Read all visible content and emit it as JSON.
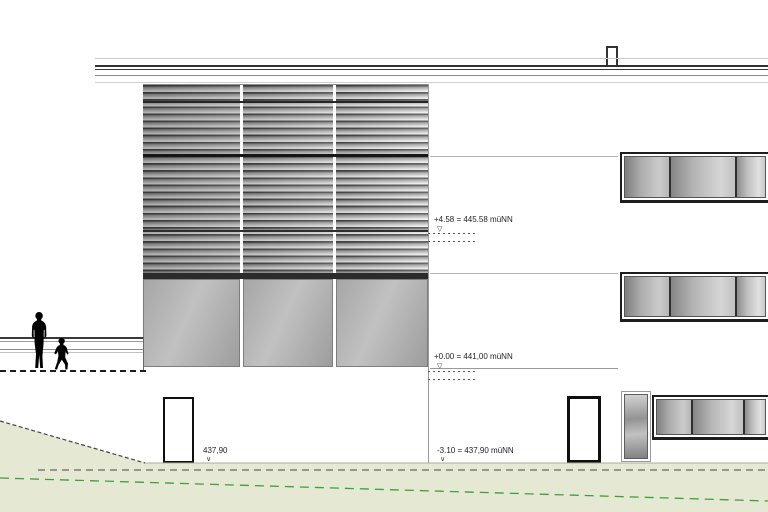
{
  "drawing": {
    "kind": "architectural elevation",
    "levels": {
      "upper": {
        "label": "+4.58 = 445.58 müNN"
      },
      "ground": {
        "label": "+0.00 = 441,00 müNN"
      },
      "basement": {
        "label": "-3.10 = 437,90 müNN"
      },
      "terrain": {
        "label": "437,90"
      }
    }
  },
  "glyphs": {
    "level_triangle": "▽",
    "level_tick": "∨"
  },
  "colors": {
    "terrain_fill": "#e5e8d2",
    "terrain_green_line": "#3f9e3f",
    "cladding_dark": "#bf9e8a",
    "cladding_light": "#e9dccf",
    "glass_dark": "#858585",
    "glass_light": "#d6d6d6",
    "line_dark": "#1d1d1d"
  }
}
